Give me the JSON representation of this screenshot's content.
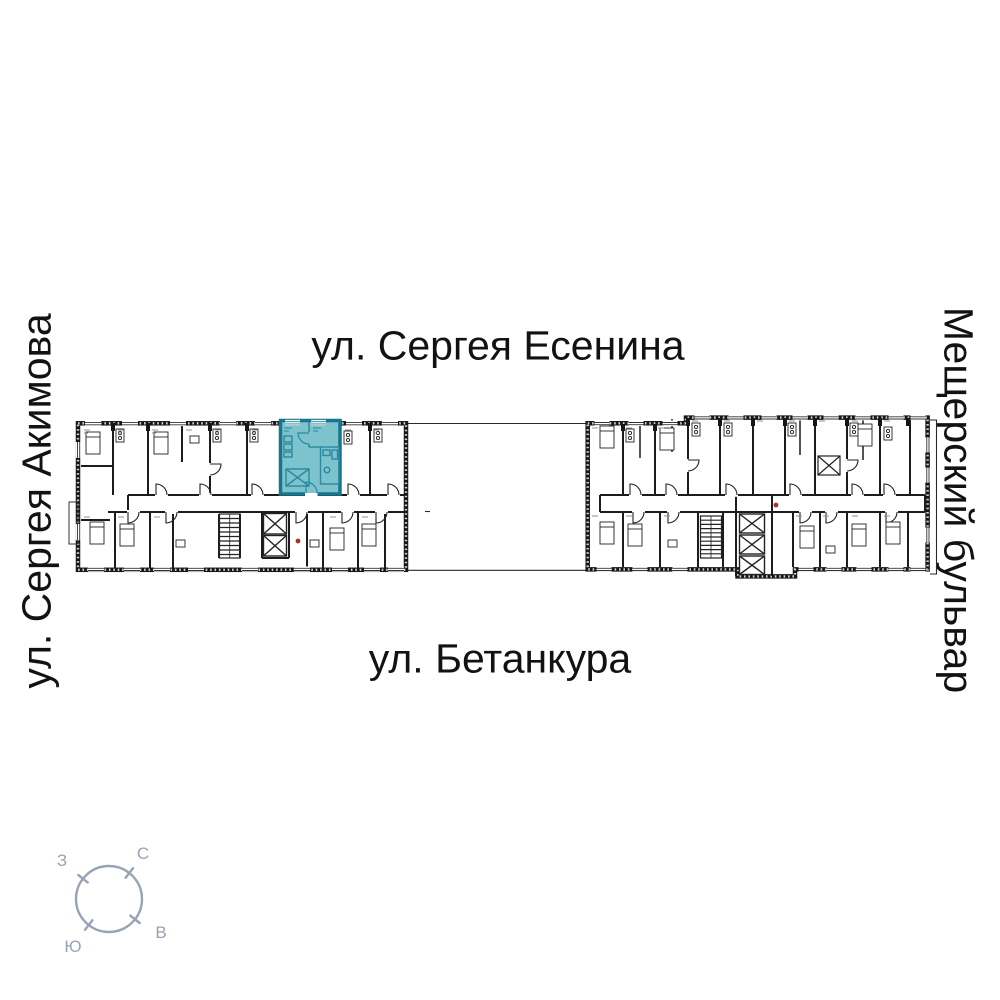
{
  "streets": {
    "top": "ул. Сергея Есенина",
    "bottom": "ул. Бетанкура",
    "left": "ул. Сергея Акимова",
    "right": "Мещерский бульвар"
  },
  "compass": {
    "north": "С",
    "east": "В",
    "south": "Ю",
    "west": "З"
  },
  "palette": {
    "highlight_fill": "#7cc3ce",
    "highlight_wall": "#17768e",
    "plan_line": "#161616",
    "compass_color": "#98a3b5",
    "accent_red": "#a83224"
  }
}
